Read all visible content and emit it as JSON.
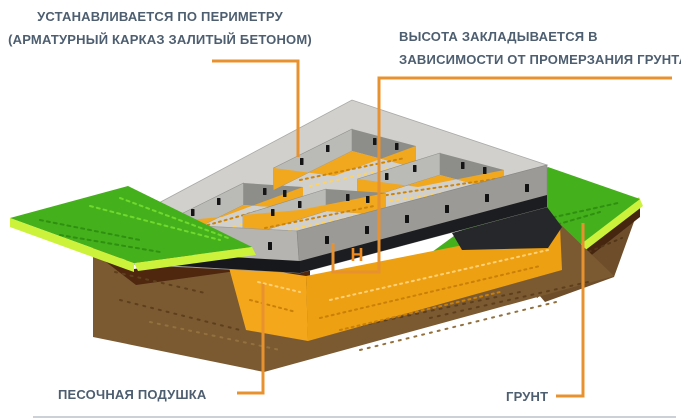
{
  "diagram": {
    "labels": {
      "perimeter": {
        "line1": "УСТАНАВЛИВАЕТСЯ ПО ПЕРИМЕТРУ",
        "line2": "(АРМАТУРНЫЙ КАРКАЗ ЗАЛИТЫЙ БЕТОНОМ)"
      },
      "height": {
        "line1": "ВЫСОТА ЗАКЛАДЫВАЕТСЯ В",
        "line2": "ЗАВИСИМОСТИ ОТ ПРОМЕРЗАНИЯ ГРУНТА"
      },
      "sand_cushion": "ПЕСОЧНАЯ ПОДУШКА",
      "soil": "ГРУНТ",
      "height_symbol": "Н"
    },
    "colors": {
      "accent_orange": "#E8922F",
      "label_text": "#4D5E70",
      "concrete_top": "#D1D0CD",
      "concrete_front": "#B5B4B1",
      "concrete_side": "#9B9A97",
      "waterproofing_black": "#17181B",
      "cell_sand": "#F1A71E",
      "sand_cushion": "#F4A71B",
      "grass_green": "#44B01C",
      "lime_edge": "#CCF23C",
      "topsoil_dark": "#4E270E",
      "soil_brown": "#7B5A31",
      "divider_gray": "#CCD1D8"
    }
  }
}
